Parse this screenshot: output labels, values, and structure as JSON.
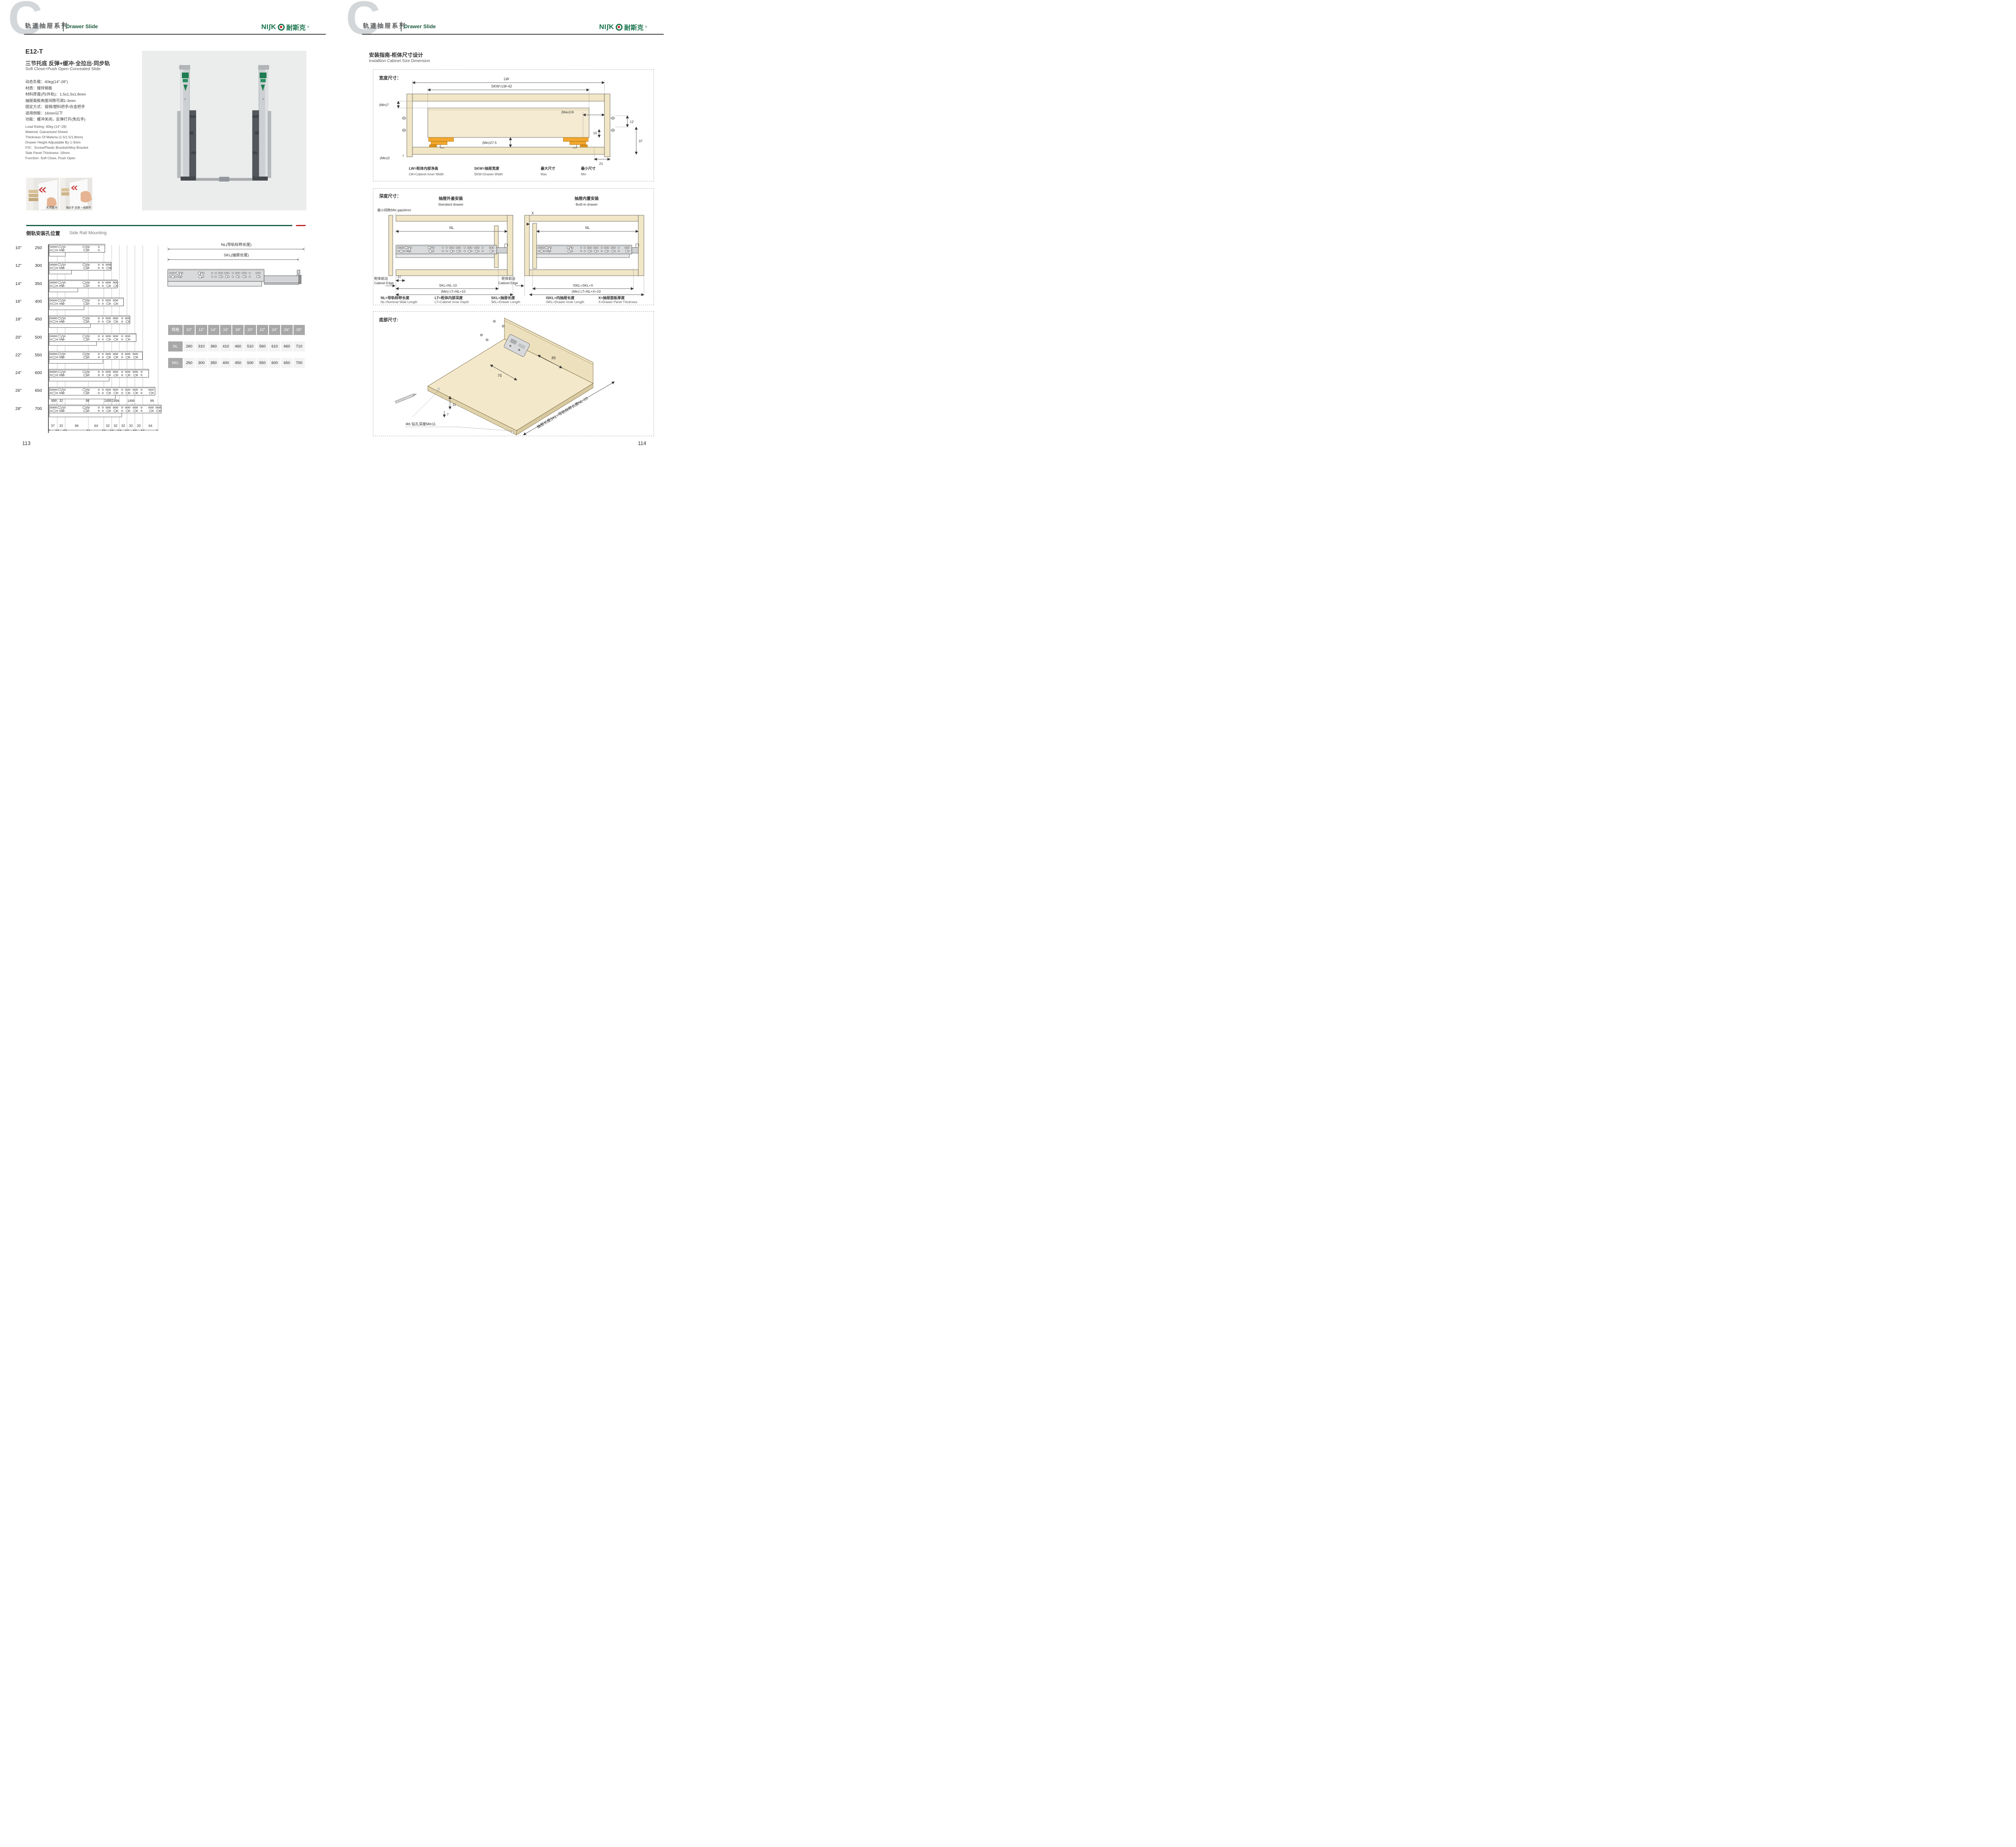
{
  "brand": {
    "logo_left": "NI",
    "logo_s": "ʃ",
    "logo_k": "K",
    "logo_cn": "耐斯克",
    "reg": "®"
  },
  "header": {
    "series_zh": "轨道抽屉系列",
    "series_en": "Drawer Slide",
    "letter": "C"
  },
  "left_page": {
    "page_number": "113",
    "model": "E12-T",
    "subtitle_zh": "三节托底 反弹+缓冲·全拉出·同步轨",
    "subtitle_en": "Soft Close+Push Open Concealed Slide",
    "specs_zh": [
      "动态负载：40kg(14\"-28\")",
      "材质：镀锌钢板",
      "材料厚度(内/外轨)：1.5x1.5x1.8mm",
      "抽屉面板高度间隙可调1-3mm",
      "固定方式：插销/塑料把手/合金把手",
      "适用侧板：16mm以下",
      "功能：缓冲关闭，反弹打开(免拉手)"
    ],
    "specs_en": [
      "Load Rating: 40kg (14\"-28)",
      "Material: Galvanized Sheed",
      "Thickness Of Materia (1.5/1.5/1.8mm)",
      "Drawer Height Adjustable By 1-3mm",
      "FIX：Screw/Plastic Bracket/Alloy Bracket",
      "Side Panel Thickness: 16mm",
      "Function: Soft Close, Push Open"
    ],
    "photos": [
      {
        "caption": "关闭缓冲"
      },
      {
        "caption": "免拉手 反弹 一按即开"
      }
    ],
    "rail_section": {
      "heading_zh": "侧轨安装孔位置",
      "heading_en": "Side Rail Mounting",
      "nl_dim_label": "NL(导轨标称长度)",
      "skl_dim_label": "SKL(抽屉长度)",
      "sizes": [
        {
          "inch": "10\"",
          "mm": "250"
        },
        {
          "inch": "12\"",
          "mm": "300"
        },
        {
          "inch": "14\"",
          "mm": "350"
        },
        {
          "inch": "16\"",
          "mm": "400"
        },
        {
          "inch": "18\"",
          "mm": "450"
        },
        {
          "inch": "20\"",
          "mm": "500"
        },
        {
          "inch": "22\"",
          "mm": "550"
        },
        {
          "inch": "24\"",
          "mm": "600"
        },
        {
          "inch": "26\"",
          "mm": "650"
        },
        {
          "inch": "28\"",
          "mm": "700"
        }
      ],
      "top_dims": [
        "999",
        "32",
        "99",
        "1499",
        "1499",
        "1499",
        "99"
      ],
      "bottom_dims": [
        "37",
        "32",
        "96",
        "64",
        "32",
        "32",
        "32",
        "32",
        "32",
        "64"
      ],
      "table": {
        "header": [
          "规格",
          "10\"",
          "12\"",
          "14\"",
          "16\"",
          "18\"",
          "20\"",
          "22\"",
          "24\"",
          "26\"",
          "28\""
        ],
        "rows": [
          {
            "label": "NL",
            "values": [
              "260",
              "310",
              "360",
              "410",
              "460",
              "510",
              "560",
              "610",
              "660",
              "710"
            ]
          },
          {
            "label": "SKL",
            "values": [
              "250",
              "300",
              "350",
              "400",
              "450",
              "500",
              "550",
              "600",
              "650",
              "700"
            ]
          }
        ]
      }
    }
  },
  "right_page": {
    "page_number": "114",
    "guide_title_zh": "安装指南-柜体尺寸设计",
    "guide_title_en": "Installtion Cabinet Size Dimension",
    "width_box": {
      "label": "宽度尺寸：",
      "lw": "LW",
      "skw": "SKW=LW-42",
      "min7": "(Min)7",
      "max16": "(Max)16",
      "d12": "12",
      "d10": "10",
      "d37": "37",
      "min275": "(Min)27.5",
      "min3": "(Min)3",
      "d21": "21",
      "legend": [
        {
          "zh": "LW=柜体内部净高",
          "en": "LW=Cabinet Inner Width"
        },
        {
          "zh": "SKW=抽屉宽度",
          "en": "SKW=Drawer Width"
        },
        {
          "zh": "最大尺寸",
          "en": "Max"
        },
        {
          "zh": "最小尺寸",
          "en": "Min"
        }
      ]
    },
    "depth_box": {
      "label": "深度尺寸：",
      "std_zh": "抽屉外盖安装",
      "std_en": "Standard drawer",
      "bi_zh": "抽屉内置安装",
      "bi_en": "Built-in drawer",
      "min_gap": "最小间隙(Min gap)4mm",
      "nl": "NL",
      "x": "X",
      "d37": "37",
      "skl": "SKL=NL-10",
      "lt_std": "(Min) LT=NL+10",
      "iskl": "ISKL=SKL+X",
      "lt_bi": "(Min) LT=NL+X+10",
      "edge_zh": "柜体前沿",
      "edge_en": "Cabinet Edge",
      "legend": [
        {
          "zh": "NL=导轨标称长度",
          "en": "NL=Nominal Slide Length"
        },
        {
          "zh": "LT=柜体内部深度",
          "en": "LT=Cabinet Inner Depth"
        },
        {
          "zh": "SKL=抽屉长度",
          "en": "SKL=Drawer Length"
        },
        {
          "zh": "ISKL=内抽屉长度",
          "en": "ISKL=Drawer Inner Length"
        },
        {
          "zh": "X=抽屉面板厚度",
          "en": "X=Drawer Panel Thickness"
        }
      ]
    },
    "bottom_box": {
      "label": "底部尺寸:",
      "d75": "75",
      "d85": "85",
      "d11": "11",
      "d7": "7",
      "drill": "Φ6 钻孔深度Min11",
      "diag": "抽屉长度SKL=导轨标称长度NL-10"
    }
  }
}
